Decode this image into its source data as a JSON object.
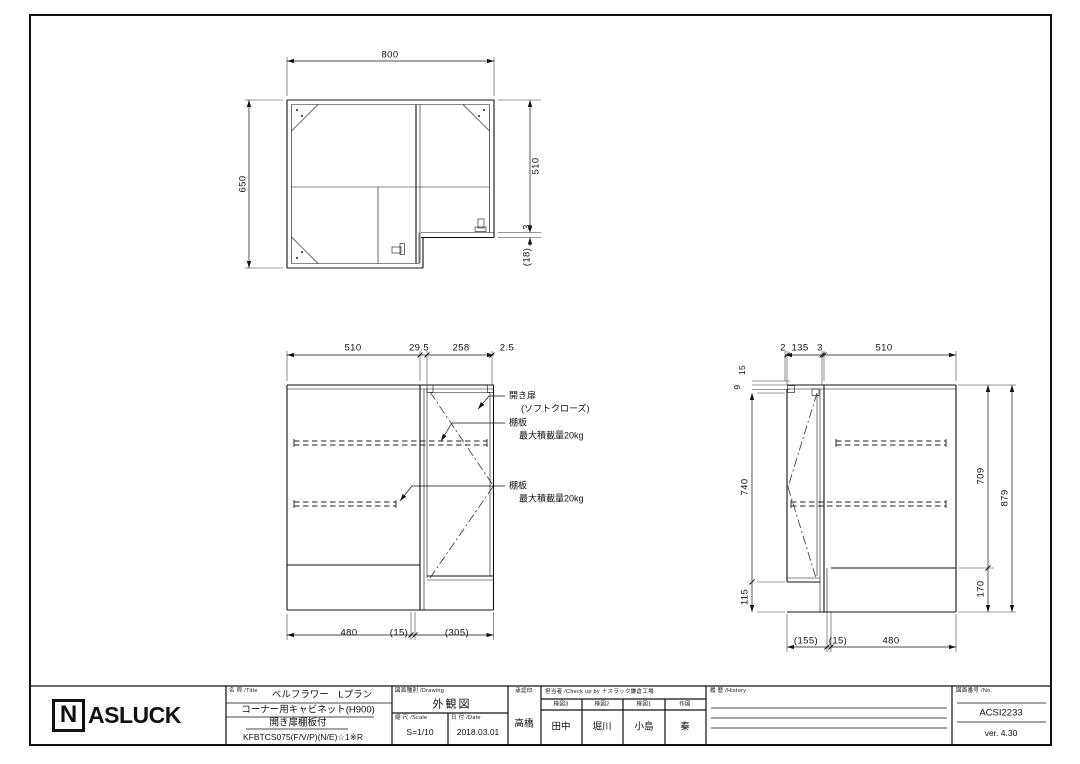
{
  "plan": {
    "width": "800",
    "depth": "650",
    "right_depth": "510",
    "gap": "3",
    "door_thk": "(18)"
  },
  "front": {
    "top": [
      "510",
      "29.5",
      "258",
      "2.5"
    ],
    "bottom": [
      "480",
      "(15)",
      "(305)"
    ],
    "ann": {
      "door": "開き扉",
      "door_sub": "(ソフトクローズ)",
      "shelf": "棚板",
      "shelf_load": "最大積載量20kg"
    }
  },
  "side": {
    "top": [
      "2",
      "135",
      "3",
      "510"
    ],
    "left_small": [
      "15",
      "9"
    ],
    "left": [
      "740",
      "115"
    ],
    "right": [
      "709",
      "879",
      "170"
    ],
    "bottom": [
      "(155)",
      "(15)",
      "480"
    ]
  },
  "titleblock": {
    "logo_n": "N",
    "logo_rest": "ASLUCK",
    "name_label": "名 称 /Title",
    "name_lines": [
      "ベルフラワー　Lプラン",
      "コーナー用キャビネット(H900)",
      "開き扉棚板付",
      "KFBTCS075(F/V/P)(N/E)☆1※R"
    ],
    "drawing_label": "図面種別 /Drawing",
    "drawing_value": "外観図",
    "scale_label": "縮 尺 /Scale",
    "scale_value": "S=1/10",
    "date_label": "日 付 /Date",
    "date_value": "2018.03.01",
    "approval_label": "承認印",
    "approval_value": "高橋",
    "check_label": "担当者 /Check up by ナスラック鎌倉工場",
    "check_cols": [
      {
        "label": "検図3",
        "value": "田中"
      },
      {
        "label": "検図2",
        "value": "堀川"
      },
      {
        "label": "検図1",
        "value": "小島"
      },
      {
        "label": "作図",
        "value": "秦"
      }
    ],
    "history_label": "履 歴 /History",
    "no_label": "図面番号 /No.",
    "no_value": "ACSI2233",
    "version": "ver. 4.30"
  }
}
